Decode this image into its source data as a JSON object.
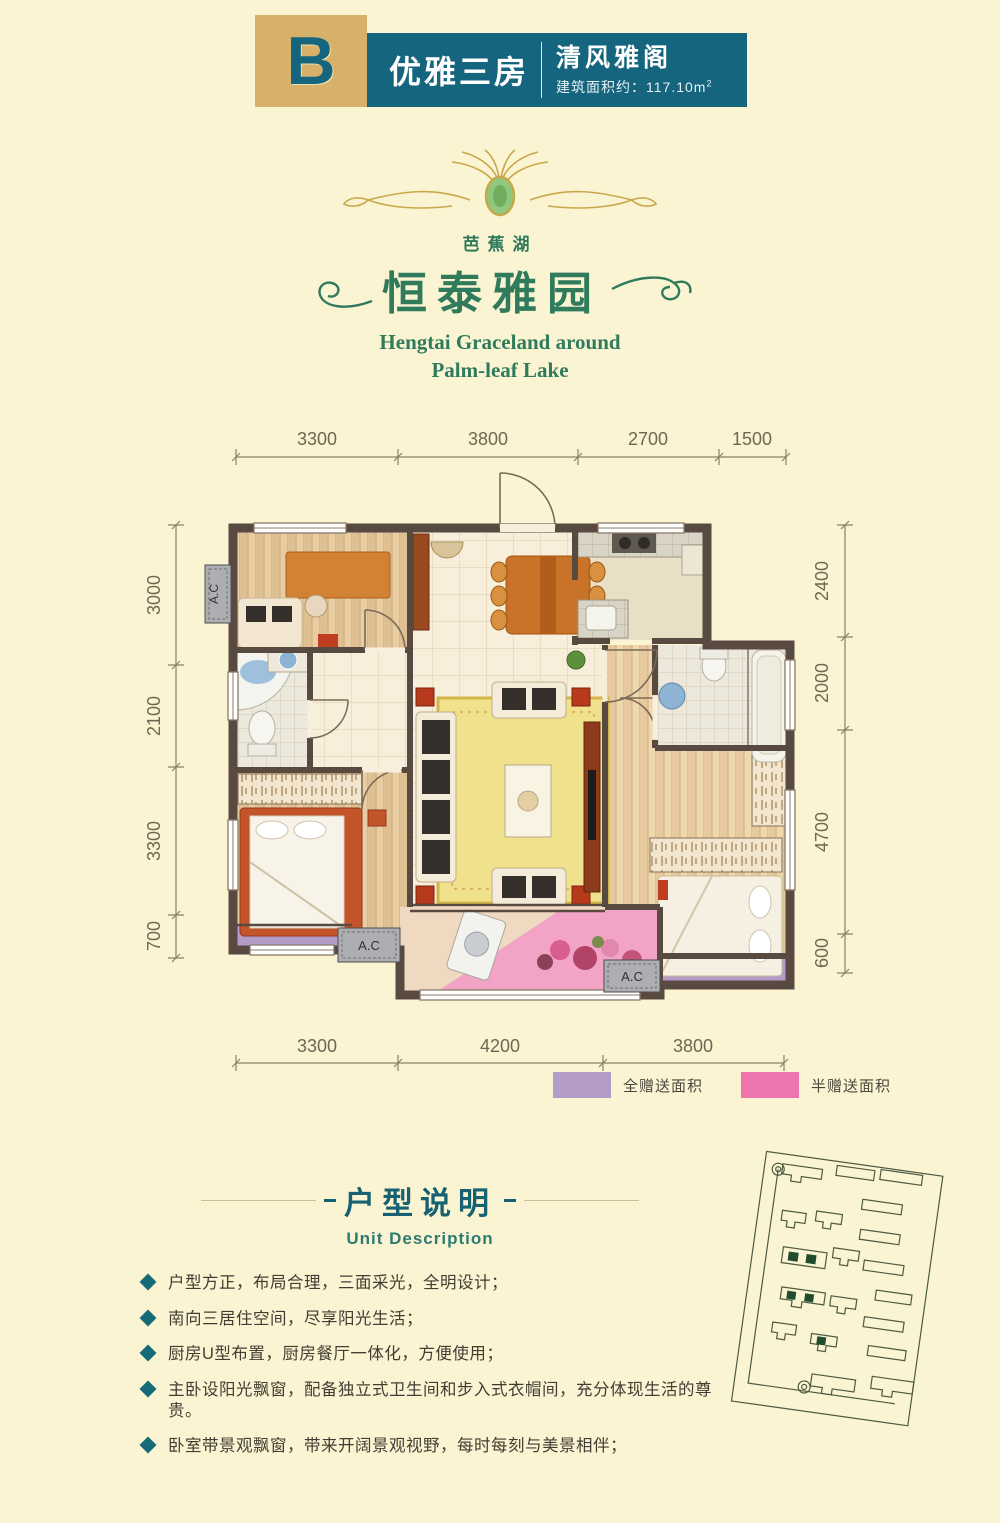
{
  "header": {
    "unit_letter": "B",
    "unit_type": "优雅三房",
    "unit_name": "清风雅阁",
    "area_label": "建筑面积约：117.10m",
    "area_sup": "2",
    "colors": {
      "gold": "#D7B169",
      "teal": "#14657D"
    }
  },
  "logo": {
    "lake_name": "芭蕉湖",
    "brand_cn": "恒泰雅园",
    "brand_en_line1": "Hengtai Graceland around",
    "brand_en_line2": "Palm-leaf Lake",
    "color": "#2F7B5B"
  },
  "plan": {
    "ac_label": "A.C",
    "dims": {
      "top": [
        "3300",
        "3800",
        "2700",
        "1500"
      ],
      "bottom": [
        "3300",
        "4200",
        "3800"
      ],
      "left": [
        "3000",
        "2100",
        "3300",
        "700"
      ],
      "right": [
        "2400",
        "2000",
        "4700",
        "600"
      ]
    },
    "wall_color": "#584941"
  },
  "legend": {
    "items": [
      {
        "label": "全赠送面积",
        "color": "#B49CC8"
      },
      {
        "label": "半赠送面积",
        "color": "#EE74AE"
      }
    ]
  },
  "description": {
    "title": "户型说明",
    "subtitle": "Unit Description",
    "bullets": [
      "户型方正，布局合理，三面采光，全明设计；",
      "南向三居住空间，尽享阳光生活；",
      "厨房U型布置，厨房餐厅一体化，方便使用；",
      "主卧设阳光飘窗，配备独立式卫生间和步入式衣帽间，充分体现生活的尊贵。",
      "卧室带景观飘窗，带来开阔景观视野，每时每刻与美景相伴；"
    ]
  }
}
